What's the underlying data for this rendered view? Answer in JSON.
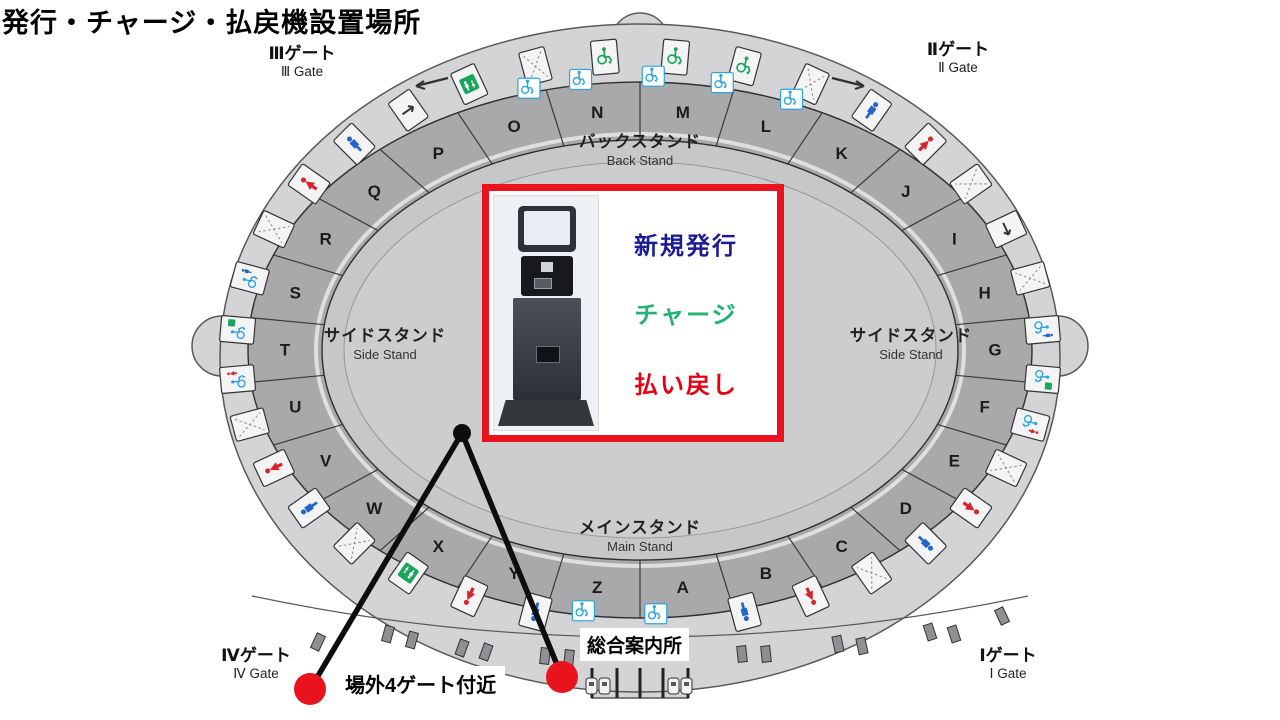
{
  "title": "発行・チャージ・払戻機設置場所",
  "gates": {
    "g1": {
      "jp": "Ⅰゲート",
      "en": "Ⅰ Gate"
    },
    "g2": {
      "jp": "Ⅱゲート",
      "en": "Ⅱ Gate"
    },
    "g3": {
      "jp": "Ⅲゲート",
      "en": "Ⅲ Gate"
    },
    "g4": {
      "jp": "Ⅳゲート",
      "en": "Ⅳ Gate"
    }
  },
  "stands": {
    "back": {
      "jp": "バックスタンド",
      "en": "Back Stand"
    },
    "main": {
      "jp": "メインスタンド",
      "en": "Main Stand"
    },
    "side_left": {
      "jp": "サイドスタンド",
      "en": "Side Stand"
    },
    "side_right": {
      "jp": "サイドスタンド",
      "en": "Side Stand"
    }
  },
  "sections": [
    "A",
    "B",
    "C",
    "D",
    "E",
    "F",
    "G",
    "H",
    "I",
    "J",
    "K",
    "L",
    "M",
    "N",
    "O",
    "P",
    "Q",
    "R",
    "S",
    "T",
    "U",
    "V",
    "W",
    "X",
    "Y",
    "Z"
  ],
  "info_box": {
    "lines": [
      {
        "text": "新規発行",
        "color": "#1c1c96"
      },
      {
        "text": "チャージ",
        "color": "#23b273"
      },
      {
        "text": "払い戻し",
        "color": "#e60012"
      }
    ]
  },
  "callouts": {
    "outside_gate4": "場外4ゲート付近",
    "info_center": "総合案内所"
  },
  "facility_icons": [
    "wheelchair-seating",
    "wheelchair-seating",
    "stairs",
    "mens-toilet",
    "womens-toilet",
    "stairs",
    "escalator",
    "stairs",
    "accessible-toilet-men",
    "accessible-toilet-family",
    "accessible-toilet-women",
    "stairs",
    "womens-toilet",
    "mens-toilet",
    "stairs",
    "womens-toilet",
    "mens-toilet",
    "blank",
    "blank",
    "mens-toilet",
    "womens-toilet",
    "family-room",
    "stairs",
    "mens-toilet",
    "womens-toilet",
    "stairs",
    "accessible-toilet-women",
    "accessible-toilet-family",
    "accessible-toilet-men",
    "stairs",
    "womens-toilet",
    "mens-toilet",
    "escalator",
    "family-room",
    "stairs",
    "wheelchair-seating"
  ],
  "accessible_seat_boxes": [
    "wheelchair",
    "wheelchair",
    "wheelchair",
    "wheelchair",
    "wheelchair",
    "wheelchair",
    "wheelchair"
  ],
  "colors": {
    "accent_red": "#e8131c",
    "men_blue": "#2565c7",
    "women_red": "#d6242c",
    "wheelchair_blue": "#2ba3dc",
    "wheelchair_green": "#18a55e",
    "concourse_gray": "#d4d4d6",
    "band_gray": "#a9a9ab",
    "bowl_gray": "#c7c7c9"
  }
}
